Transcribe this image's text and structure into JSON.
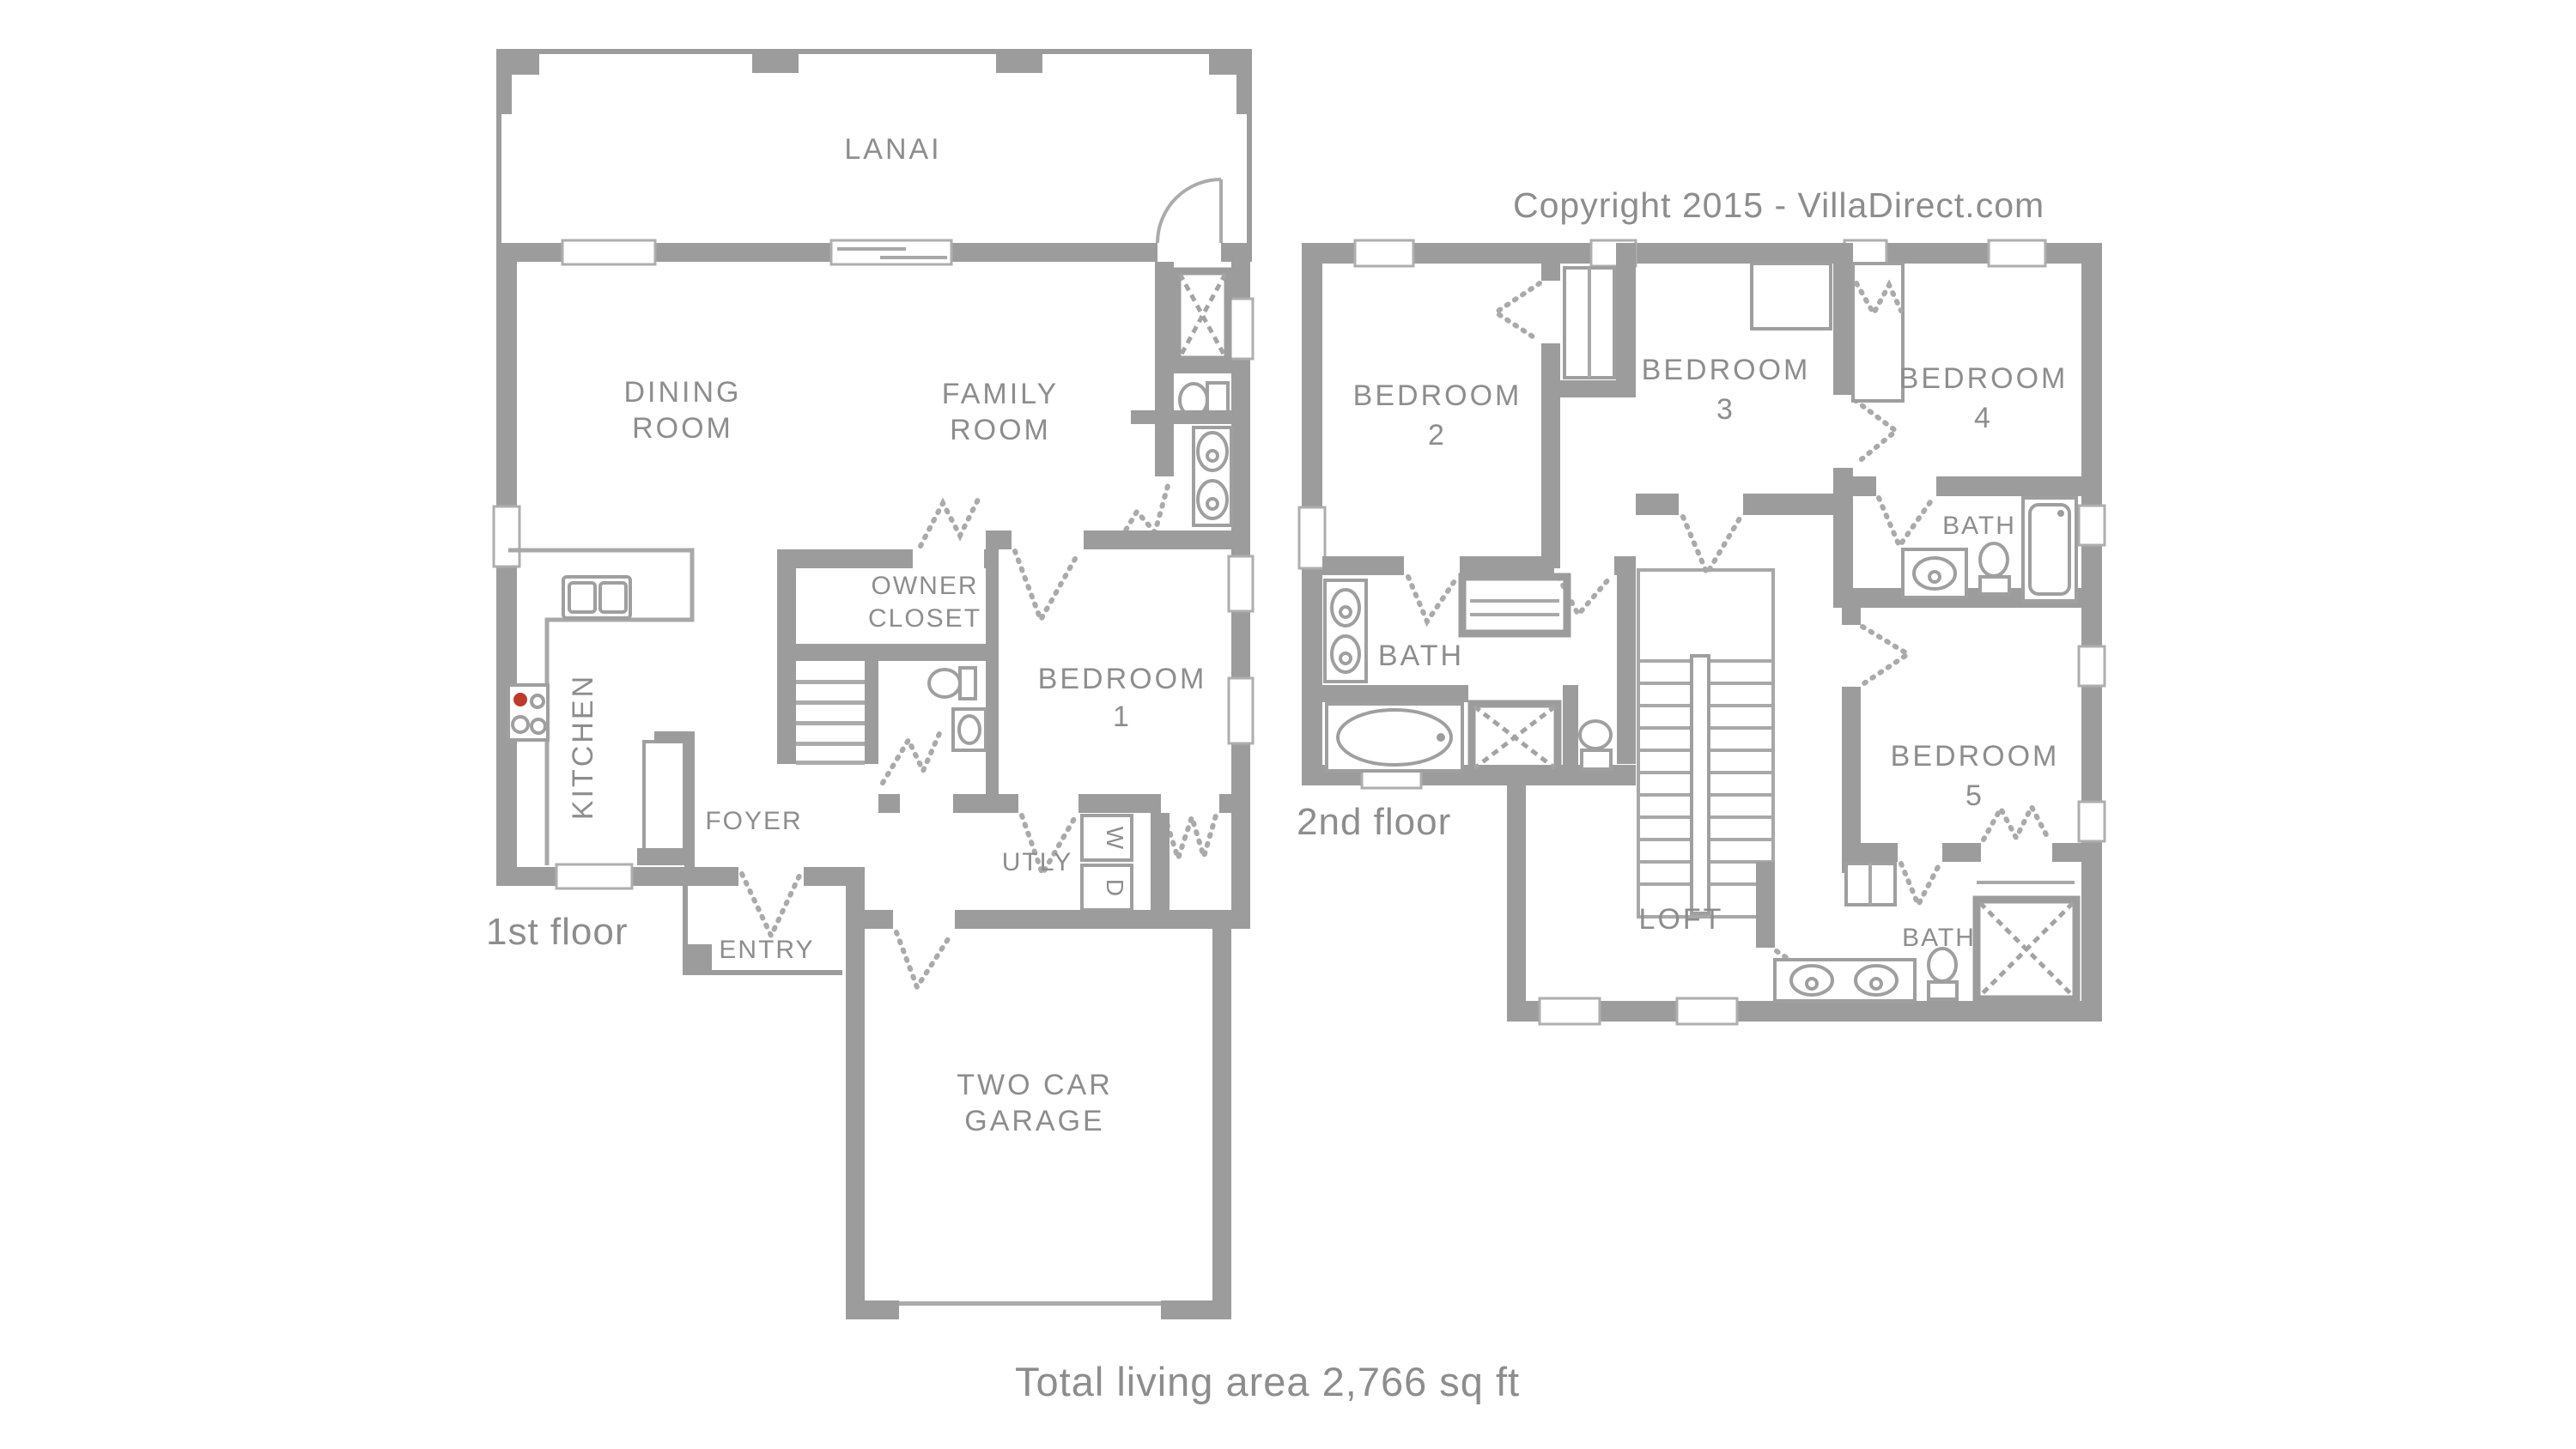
{
  "copyright_text": "Copyright 2015 - VillaDirect.com",
  "total_area_text": "Total living area 2,766 sq ft",
  "colors": {
    "wall": "#9c9c9c",
    "thin_line": "#a8a8a8",
    "label_text": "#8d8d8d",
    "stove_burner_red": "#c0392b",
    "background": "#ffffff"
  },
  "floor1": {
    "floor_label": "1st floor",
    "rooms": {
      "lanai": "LANAI",
      "dining_room": [
        "DINING",
        "ROOM"
      ],
      "family_room": [
        "FAMILY",
        "ROOM"
      ],
      "owner_closet": [
        "OWNER",
        "CLOSET"
      ],
      "bedroom_1": [
        "BEDROOM",
        "1"
      ],
      "kitchen": "KITCHEN",
      "foyer": "FOYER",
      "entry": "ENTRY",
      "utility": "UTLY",
      "washer": "W",
      "dryer": "D",
      "garage": [
        "TWO CAR",
        "GARAGE"
      ]
    }
  },
  "floor2": {
    "floor_label": "2nd floor",
    "rooms": {
      "bedroom_2": [
        "BEDROOM",
        "2"
      ],
      "bedroom_3": [
        "BEDROOM",
        "3"
      ],
      "bedroom_4": [
        "BEDROOM",
        "4"
      ],
      "bath_hall": "BATH",
      "bath_master": "BATH",
      "loft": "LOFT",
      "bedroom_5": [
        "BEDROOM",
        "5"
      ],
      "bath_bedroom5": "BATH"
    }
  }
}
